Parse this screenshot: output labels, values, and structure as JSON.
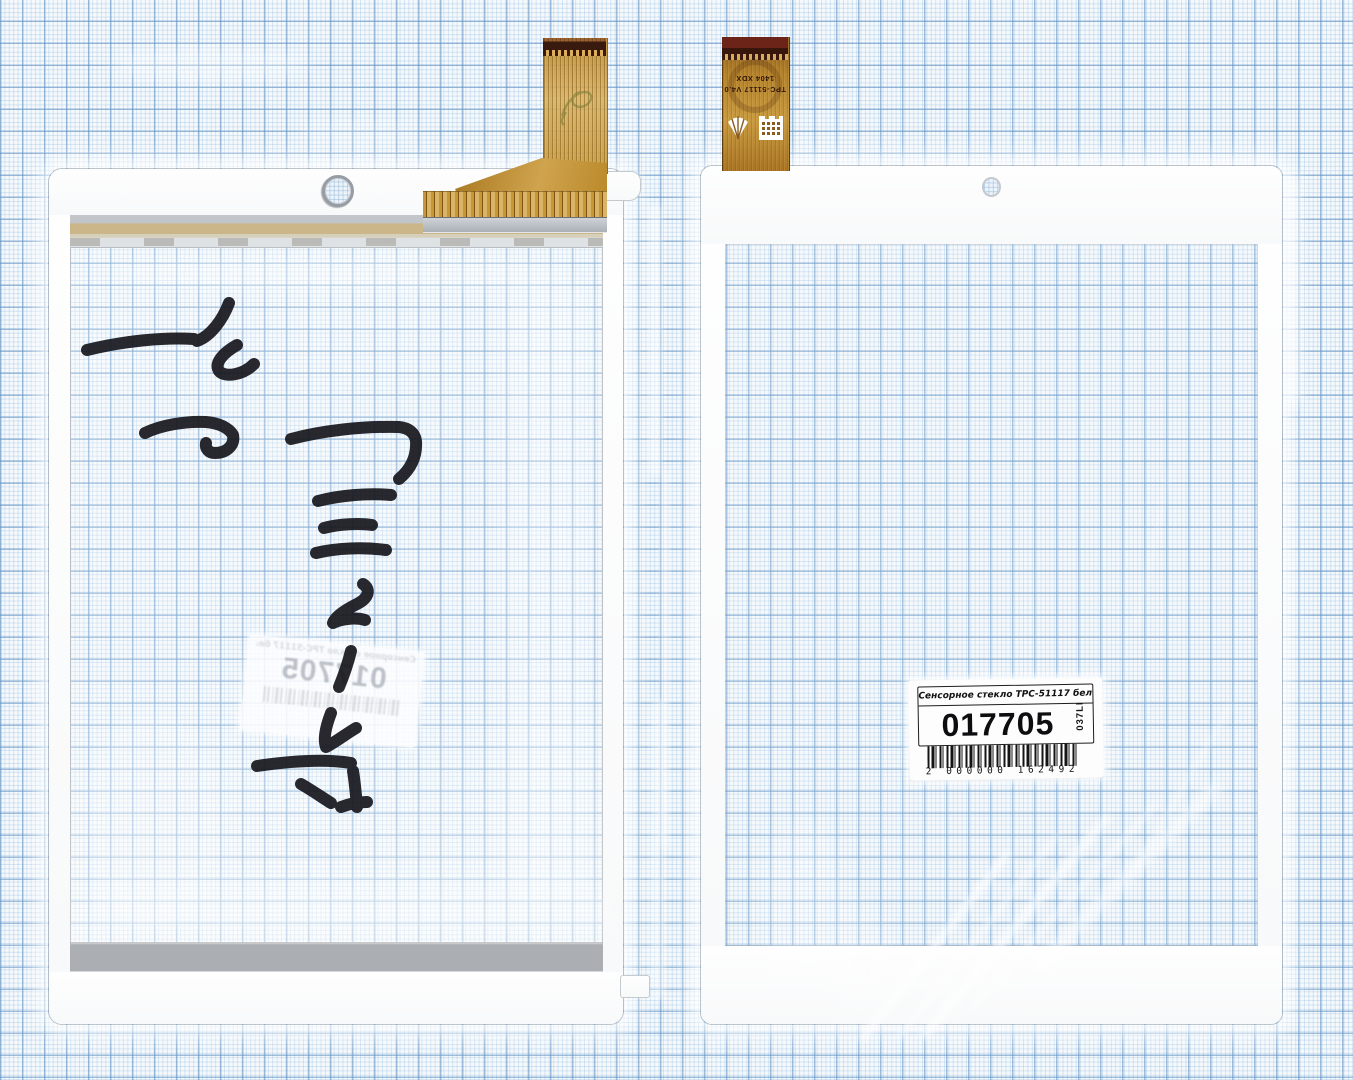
{
  "left_panel": {
    "mirrored_label": {
      "title": "Сенсорное стекло TPC-51117 белый",
      "number": "017705"
    }
  },
  "right_panel": {
    "label": {
      "title": "Сенсорное стекло TPC-51117 белый",
      "number": "017705",
      "side_code": "037LI",
      "barcode_text": "2 000000 162492"
    },
    "cable": {
      "model_text": "TPC-51117 V4.0",
      "batch_text": "1404 XDX"
    }
  },
  "icons": {
    "camera_hole": "circle-through-hole",
    "fan_logo": "white-fan-rays",
    "building_logo": "white-brick-building"
  },
  "colors": {
    "paper_bg": "#f5f9fc",
    "paper_major_line": "#7aa6cc",
    "paper_minor_line": "#c4daec",
    "panel_white": "#fdfdfe",
    "cable_gold": "#c2923​8",
    "cable_dark_tip": "#3a180c",
    "adhesive_gray": "#abaeb3",
    "adhesive_tan": "#c9b488",
    "marker_ink": "#17171d",
    "label_text": "#111111"
  }
}
